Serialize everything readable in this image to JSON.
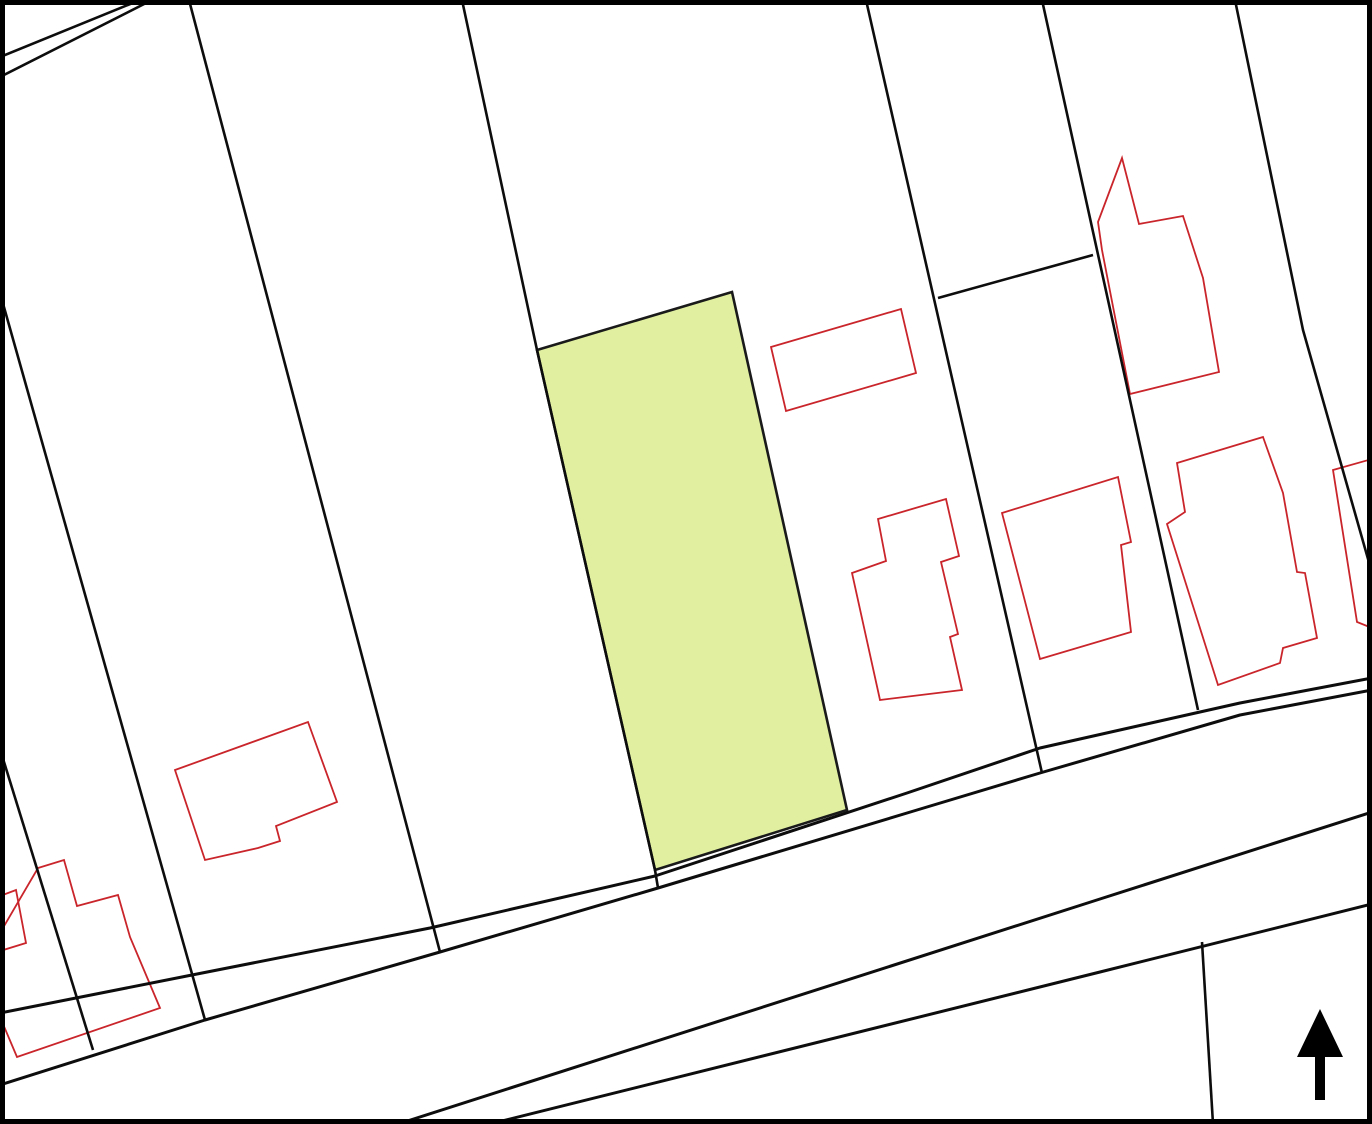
{
  "map": {
    "title": "cadastral-site-plan",
    "width": 1372,
    "height": 1124,
    "background": "#ffffff",
    "frame": {
      "color": "#000000",
      "stroke_width": 5
    },
    "colors": {
      "boundary": "#0d0d0d",
      "road": "#0d0d0d",
      "building_outline": "#c9252b",
      "highlight_fill": "#e0f0a0",
      "highlight_stroke": "#1a1a1a",
      "arrow": "#000000"
    },
    "stroke_widths": {
      "boundary": 2.6,
      "road": 3.0,
      "building": 1.8,
      "highlight": 2.6
    },
    "highlight_parcel": {
      "name": "highlighted-parcel",
      "points": [
        [
          537,
          350
        ],
        [
          732,
          292
        ],
        [
          847,
          810
        ],
        [
          655,
          870
        ]
      ]
    },
    "boundary_lines": [
      {
        "name": "path-edge-top-left-outer",
        "points": [
          [
            0,
            57
          ],
          [
            140,
            0
          ]
        ]
      },
      {
        "name": "path-edge-top-left-inner",
        "points": [
          [
            0,
            77
          ],
          [
            152,
            0
          ]
        ]
      },
      {
        "name": "parcel-line-far-left",
        "points": [
          [
            0,
            749
          ],
          [
            93,
            1050
          ]
        ]
      },
      {
        "name": "parcel-line-1",
        "points": [
          [
            0,
            293
          ],
          [
            205,
            1020
          ]
        ]
      },
      {
        "name": "parcel-line-2",
        "points": [
          [
            189,
            0
          ],
          [
            440,
            952
          ]
        ]
      },
      {
        "name": "parcel-line-3-highlight-west",
        "points": [
          [
            462,
            0
          ],
          [
            537,
            350
          ],
          [
            655,
            870
          ],
          [
            658,
            888
          ]
        ]
      },
      {
        "name": "parcel-line-4",
        "points": [
          [
            866,
            0
          ],
          [
            957,
            400
          ],
          [
            1042,
            773
          ]
        ]
      },
      {
        "name": "parcel-line-5",
        "points": [
          [
            1042,
            0
          ],
          [
            1130,
            400
          ],
          [
            1198,
            710
          ]
        ]
      },
      {
        "name": "parcel-line-6",
        "points": [
          [
            1235,
            0
          ],
          [
            1303,
            330
          ],
          [
            1372,
            573
          ]
        ]
      },
      {
        "name": "parcel-cross-boundary",
        "points": [
          [
            938,
            298
          ],
          [
            1093,
            255
          ]
        ]
      },
      {
        "name": "parcel-line-road-corner",
        "points": [
          [
            1202,
            942
          ],
          [
            1213,
            1124
          ]
        ]
      }
    ],
    "road_lines": [
      {
        "name": "road-north-edge-outer",
        "points": [
          [
            0,
            1013
          ],
          [
            192,
            975
          ],
          [
            430,
            928
          ],
          [
            655,
            876
          ],
          [
            907,
            793
          ],
          [
            1040,
            748
          ],
          [
            1240,
            703
          ],
          [
            1372,
            678
          ]
        ]
      },
      {
        "name": "road-north-edge-inner",
        "points": [
          [
            0,
            1085
          ],
          [
            205,
            1020
          ],
          [
            440,
            952
          ],
          [
            658,
            888
          ],
          [
            917,
            810
          ],
          [
            1040,
            773
          ],
          [
            1240,
            715
          ],
          [
            1372,
            690
          ]
        ]
      },
      {
        "name": "road-south-edge-inner",
        "points": [
          [
            398,
            1124
          ],
          [
            1100,
            899
          ],
          [
            1372,
            812
          ]
        ]
      },
      {
        "name": "road-south-edge-outer",
        "points": [
          [
            490,
            1124
          ],
          [
            1100,
            972
          ],
          [
            1372,
            904
          ]
        ]
      }
    ],
    "buildings": [
      {
        "name": "building-left-edge-small",
        "points": [
          [
            0,
            896
          ],
          [
            16,
            890
          ],
          [
            26,
            943
          ],
          [
            0,
            951
          ]
        ]
      },
      {
        "name": "building-left-cluster",
        "points": [
          [
            38,
            868
          ],
          [
            64,
            860
          ],
          [
            77,
            906
          ],
          [
            118,
            895
          ],
          [
            130,
            937
          ],
          [
            160,
            1008
          ],
          [
            17,
            1057
          ],
          [
            0,
            1017
          ],
          [
            0,
            933
          ]
        ]
      },
      {
        "name": "building-mid-left",
        "points": [
          [
            175,
            770
          ],
          [
            308,
            722
          ],
          [
            337,
            802
          ],
          [
            276,
            826
          ],
          [
            280,
            841
          ],
          [
            258,
            848
          ],
          [
            205,
            860
          ]
        ]
      },
      {
        "name": "building-east-of-highlight",
        "points": [
          [
            771,
            347
          ],
          [
            901,
            309
          ],
          [
            916,
            373
          ],
          [
            786,
            411
          ]
        ]
      },
      {
        "name": "building-center-right",
        "points": [
          [
            852,
            573
          ],
          [
            886,
            561
          ],
          [
            878,
            519
          ],
          [
            946,
            499
          ],
          [
            959,
            556
          ],
          [
            941,
            562
          ],
          [
            958,
            634
          ],
          [
            950,
            637
          ],
          [
            962,
            690
          ],
          [
            880,
            700
          ]
        ]
      },
      {
        "name": "building-top-right-large",
        "points": [
          [
            1122,
            158
          ],
          [
            1139,
            224
          ],
          [
            1183,
            216
          ],
          [
            1203,
            278
          ],
          [
            1219,
            372
          ],
          [
            1130,
            394
          ],
          [
            1102,
            250
          ],
          [
            1098,
            222
          ]
        ]
      },
      {
        "name": "building-right-row-a",
        "points": [
          [
            1002,
            513
          ],
          [
            1118,
            477
          ],
          [
            1131,
            542
          ],
          [
            1121,
            545
          ],
          [
            1131,
            632
          ],
          [
            1040,
            659
          ]
        ]
      },
      {
        "name": "building-right-row-b",
        "points": [
          [
            1263,
            437
          ],
          [
            1283,
            493
          ],
          [
            1297,
            572
          ],
          [
            1305,
            573
          ],
          [
            1317,
            638
          ],
          [
            1283,
            648
          ],
          [
            1280,
            663
          ],
          [
            1218,
            685
          ],
          [
            1167,
            524
          ],
          [
            1185,
            512
          ],
          [
            1177,
            463
          ]
        ]
      },
      {
        "name": "building-right-edge-clipped",
        "points": [
          [
            1333,
            470
          ],
          [
            1372,
            459
          ],
          [
            1372,
            628
          ],
          [
            1357,
            622
          ]
        ]
      }
    ],
    "north_arrow": {
      "name": "north-arrow-icon",
      "tip": [
        1320,
        1009
      ],
      "head_base_y": 1057,
      "head_half_width": 23,
      "stem_half_width": 5,
      "stem_bottom_y": 1100
    }
  }
}
